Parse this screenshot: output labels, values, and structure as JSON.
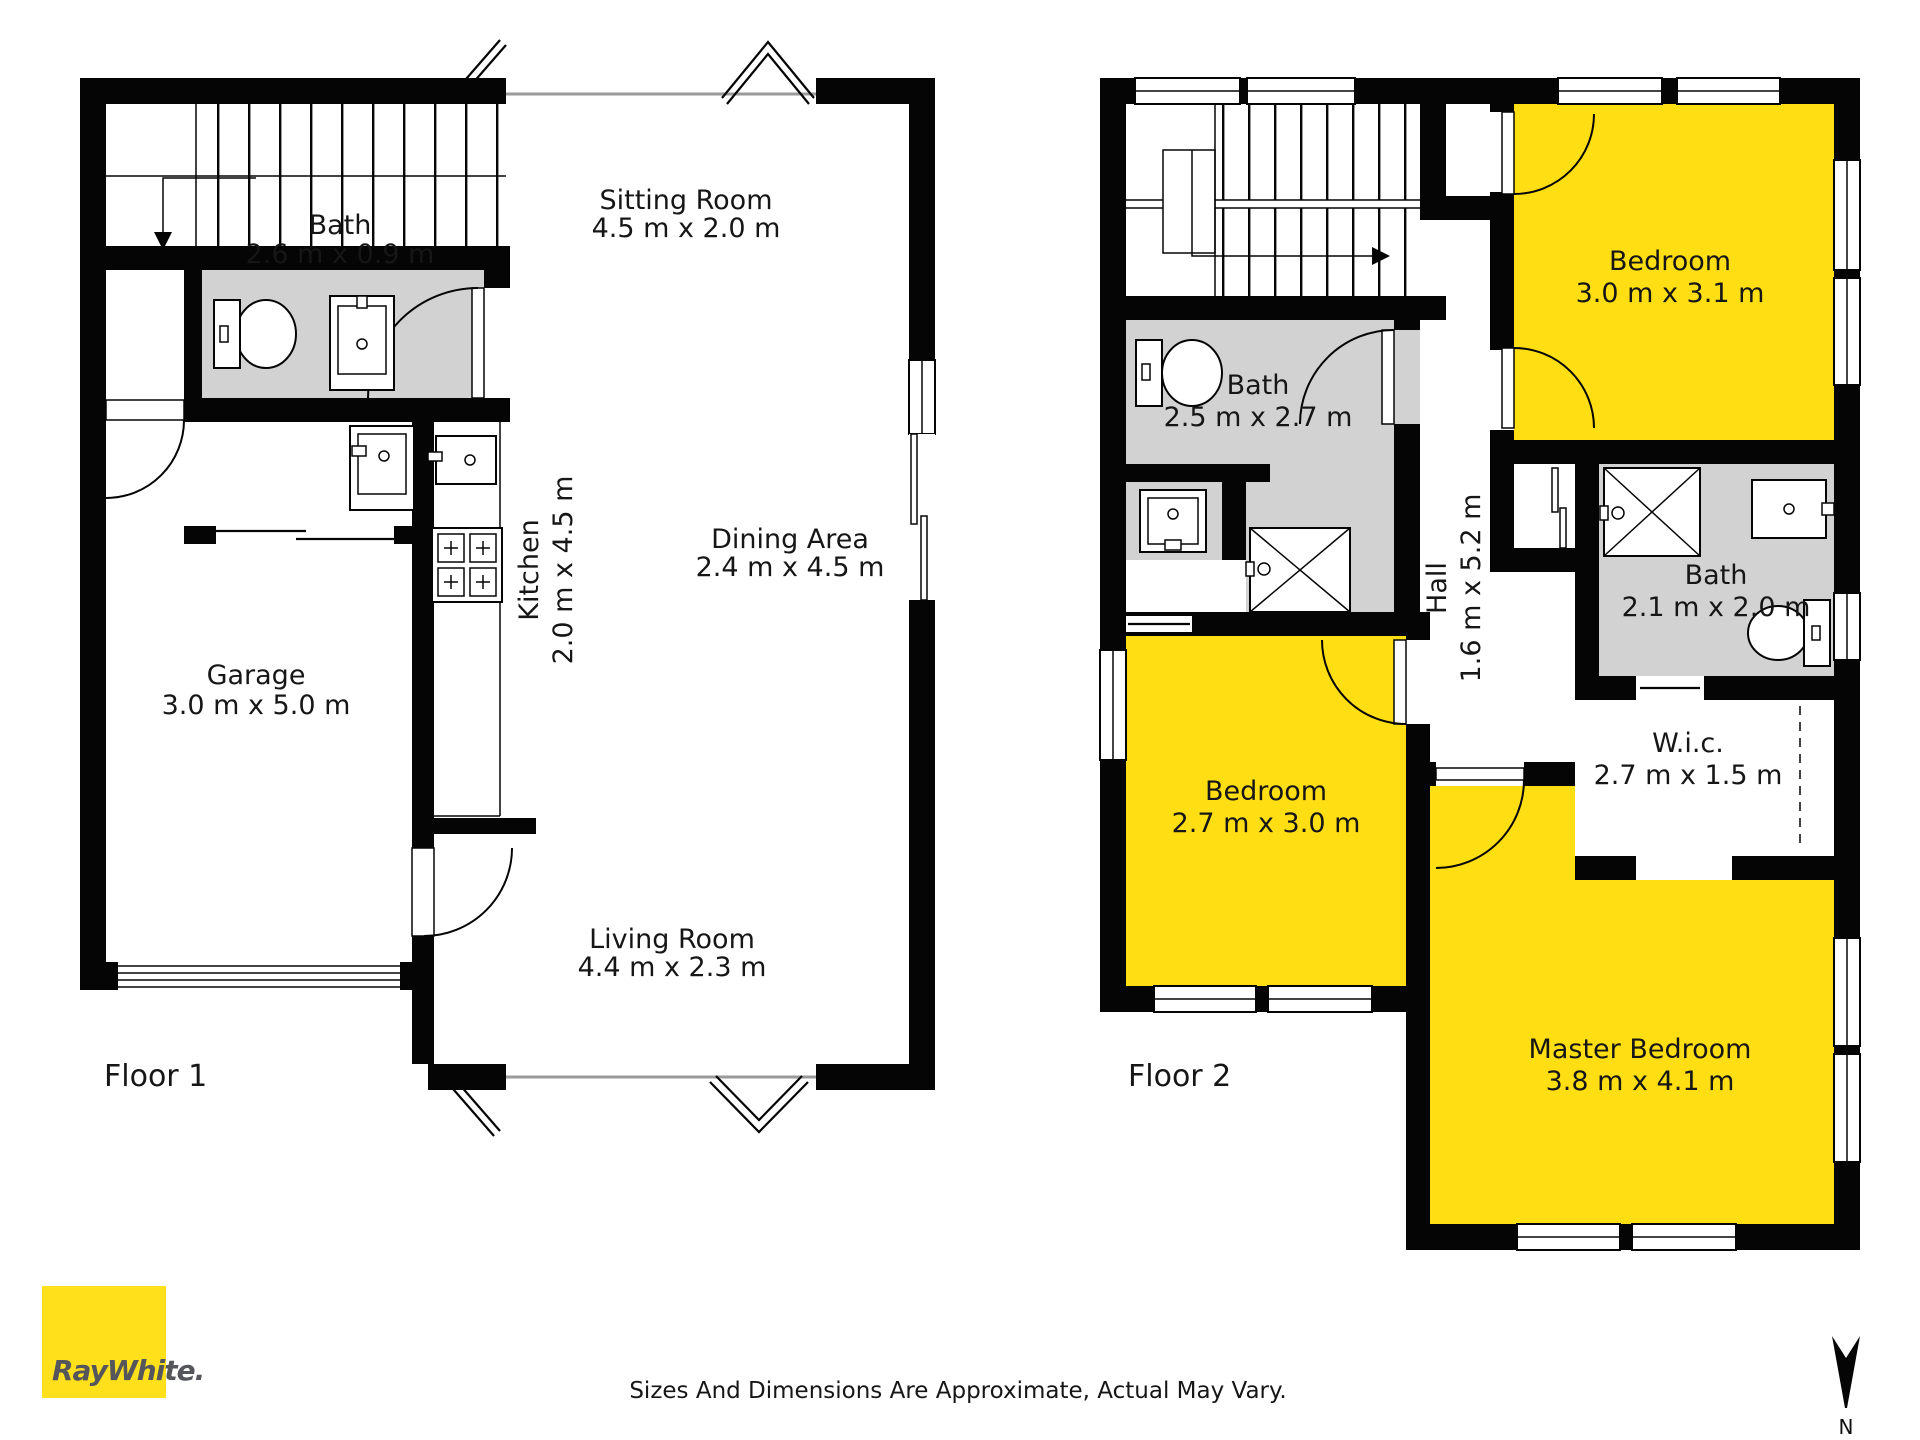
{
  "floor1": {
    "label": "Floor 1",
    "rooms": {
      "bath": {
        "name": "Bath",
        "dims": "2.6 m x 0.9 m"
      },
      "sitting": {
        "name": "Sitting Room",
        "dims": "4.5 m x 2.0 m"
      },
      "kitchen": {
        "name": "Kitchen",
        "dims": "2.0 m x 4.5 m"
      },
      "dining": {
        "name": "Dining Area",
        "dims": "2.4 m x 4.5 m"
      },
      "garage": {
        "name": "Garage",
        "dims": "3.0 m x 5.0 m"
      },
      "living": {
        "name": "Living Room",
        "dims": "4.4 m x 2.3 m"
      }
    }
  },
  "floor2": {
    "label": "Floor 2",
    "rooms": {
      "bath_top": {
        "name": "Bath",
        "dims": "2.5 m x 2.7 m"
      },
      "bedroom_top": {
        "name": "Bedroom",
        "dims": "3.0 m x 3.1 m"
      },
      "hall": {
        "name": "Hall",
        "dims": "1.6 m x 5.2 m"
      },
      "bath_right": {
        "name": "Bath",
        "dims": "2.1 m x 2.0 m"
      },
      "wic": {
        "name": "W.i.c.",
        "dims": "2.7 m x 1.5 m"
      },
      "bedroom_left": {
        "name": "Bedroom",
        "dims": "2.7 m x 3.0 m"
      },
      "master": {
        "name": "Master Bedroom",
        "dims": "3.8 m x 4.1 m"
      }
    }
  },
  "footer": {
    "disclaimer": "Sizes And Dimensions Are Approximate, Actual May Vary.",
    "brand": "RayWhite.",
    "north_label": "N"
  },
  "colors": {
    "room_yellow": "#ffdf13",
    "bath_gray": "#d2d2d2",
    "wall_black": "#050505",
    "logo_yellow": "#ffe01a",
    "logo_text": "#54565b"
  }
}
